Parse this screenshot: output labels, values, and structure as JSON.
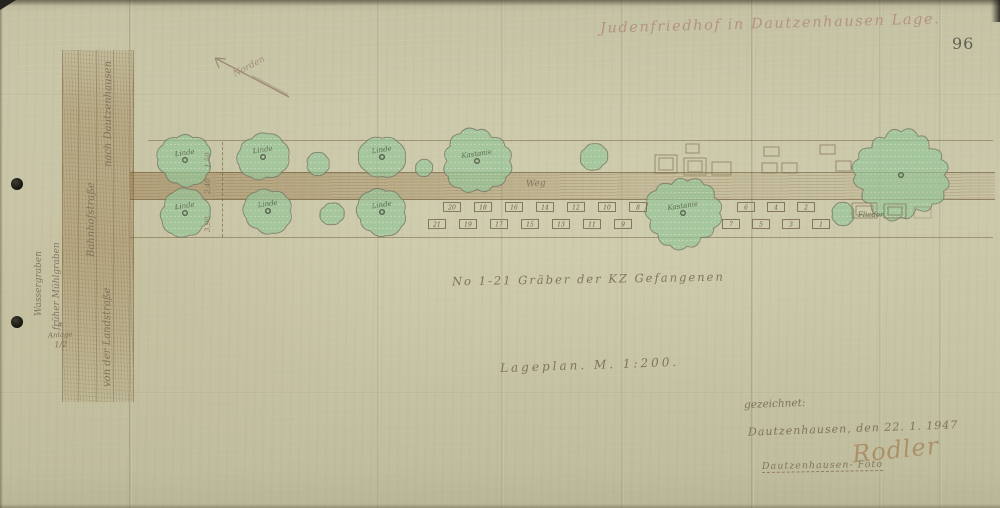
{
  "document": {
    "title": "Judenfriedhof in Dautzenhausen Lage.",
    "page_number": "96",
    "graves_note": "No 1-21 Gräber der KZ Gefangenen",
    "scale_note": "Lageplan. M. 1:200.",
    "annex": {
      "mark": "#",
      "word": "Anlage",
      "number": "1/2"
    }
  },
  "plan_labels": {
    "weg": "Weg",
    "norden": "Norden",
    "road_destination": "nach Dautzenhausen",
    "street_name": "Bahnhofstraße",
    "ditch_1": "Wassergraben",
    "ditch_2": "früher Mühlgraben",
    "road_origin": "von der Landstraße",
    "dimensions": [
      "1,50",
      "2,40",
      "3,90"
    ]
  },
  "signature_block": {
    "drawn_by": "gezeichnet:",
    "place_date": "Dautzenhausen, den 22. 1. 1947",
    "signature": "Rodler",
    "stamp_line": "Dautzenhausen- Foto"
  },
  "plan": {
    "trees": [
      {
        "cx": 185,
        "cy": 160,
        "r": 27,
        "label": "Linde"
      },
      {
        "cx": 263,
        "cy": 157,
        "r": 25,
        "label": "Linde"
      },
      {
        "cx": 318,
        "cy": 164,
        "r": 12,
        "label": ""
      },
      {
        "cx": 382,
        "cy": 157,
        "r": 23,
        "label": "Linde"
      },
      {
        "cx": 424,
        "cy": 168,
        "r": 9,
        "label": ""
      },
      {
        "cx": 477,
        "cy": 161,
        "r": 33,
        "label": "Kastanie"
      },
      {
        "cx": 594,
        "cy": 157,
        "r": 14,
        "label": ""
      },
      {
        "cx": 901,
        "cy": 175,
        "r": 45,
        "label": ""
      },
      {
        "cx": 185,
        "cy": 213,
        "r": 25,
        "label": "Linde"
      },
      {
        "cx": 268,
        "cy": 211,
        "r": 24,
        "label": "Linde"
      },
      {
        "cx": 332,
        "cy": 214,
        "r": 12,
        "label": ""
      },
      {
        "cx": 382,
        "cy": 212,
        "r": 25,
        "label": "Linde"
      },
      {
        "cx": 683,
        "cy": 213,
        "r": 36,
        "label": "Kastanie"
      },
      {
        "cx": 843,
        "cy": 214,
        "r": 12,
        "label": "Flieder",
        "label_out": true
      }
    ],
    "graves": [
      {
        "n": 21,
        "x": 437,
        "y": 224
      },
      {
        "n": 19,
        "x": 468,
        "y": 224
      },
      {
        "n": 17,
        "x": 499,
        "y": 224
      },
      {
        "n": 15,
        "x": 530,
        "y": 224
      },
      {
        "n": 13,
        "x": 561,
        "y": 224
      },
      {
        "n": 11,
        "x": 592,
        "y": 224
      },
      {
        "n": 9,
        "x": 623,
        "y": 224
      },
      {
        "n": 20,
        "x": 452,
        "y": 207
      },
      {
        "n": 18,
        "x": 483,
        "y": 207
      },
      {
        "n": 16,
        "x": 514,
        "y": 207
      },
      {
        "n": 14,
        "x": 545,
        "y": 207
      },
      {
        "n": 12,
        "x": 576,
        "y": 207
      },
      {
        "n": 10,
        "x": 607,
        "y": 207
      },
      {
        "n": 8,
        "x": 638,
        "y": 207
      },
      {
        "n": 7,
        "x": 731,
        "y": 224
      },
      {
        "n": 5,
        "x": 761,
        "y": 224
      },
      {
        "n": 3,
        "x": 791,
        "y": 224
      },
      {
        "n": 1,
        "x": 821,
        "y": 224
      },
      {
        "n": 6,
        "x": 746,
        "y": 207
      },
      {
        "n": 4,
        "x": 776,
        "y": 207
      },
      {
        "n": 2,
        "x": 806,
        "y": 207
      }
    ],
    "pencil_rects": [
      {
        "x": 655,
        "y": 155,
        "w": 22,
        "h": 18,
        "d": 1
      },
      {
        "x": 686,
        "y": 144,
        "w": 13,
        "h": 9
      },
      {
        "x": 684,
        "y": 158,
        "w": 22,
        "h": 17,
        "d": 1
      },
      {
        "x": 712,
        "y": 162,
        "w": 19,
        "h": 13
      },
      {
        "x": 764,
        "y": 147,
        "w": 15,
        "h": 9
      },
      {
        "x": 762,
        "y": 163,
        "w": 15,
        "h": 10
      },
      {
        "x": 782,
        "y": 163,
        "w": 15,
        "h": 10
      },
      {
        "x": 820,
        "y": 145,
        "w": 15,
        "h": 9
      },
      {
        "x": 836,
        "y": 161,
        "w": 15,
        "h": 10
      },
      {
        "x": 852,
        "y": 203,
        "w": 25,
        "h": 15,
        "d": 1
      },
      {
        "x": 884,
        "y": 204,
        "w": 22,
        "h": 14,
        "d": 1
      },
      {
        "x": 914,
        "y": 207,
        "w": 17,
        "h": 11,
        "light": 1
      }
    ]
  },
  "colors": {
    "paper": "#c6c3a4",
    "tree_green": "#8cc794",
    "pencil_brown": "#8a7a64",
    "ink_gray": "#786a54",
    "title_red": "#b28a7e"
  }
}
